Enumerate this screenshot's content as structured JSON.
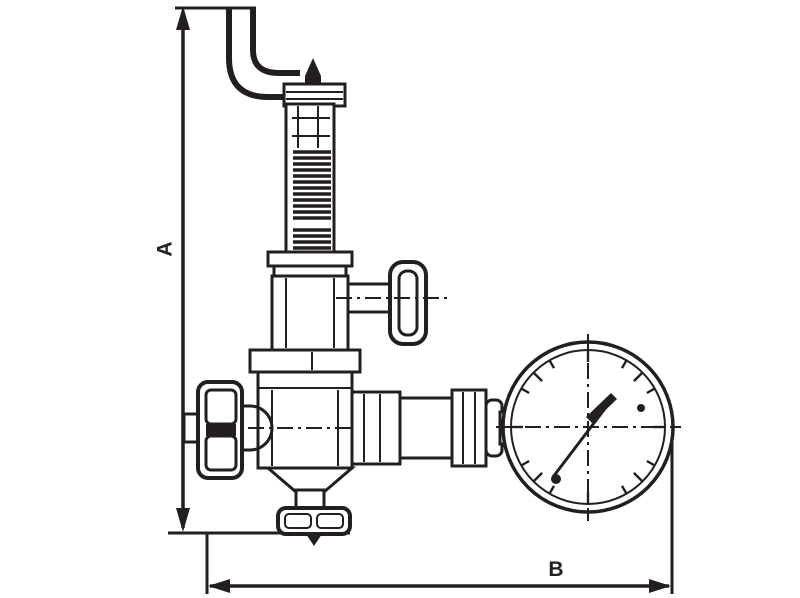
{
  "diagram": {
    "kind": "technical-line-drawing",
    "subject": "safety relief valve with side handle and pressure gauge, with overall dimensions",
    "labels": {
      "dimension_vertical": "A",
      "dimension_horizontal": "B"
    },
    "colors": {
      "line": "#231f20",
      "background": "#ffffff"
    },
    "components": [
      "exhaust-pipe-elbow",
      "stem-tip",
      "spring-housing",
      "housing-flange",
      "bonnet",
      "adjustment-t-handle",
      "body-flange",
      "valve-body",
      "inlet-union-nut",
      "inlet-stub",
      "outlet-neck",
      "outlet-cylinder",
      "outlet-hex-nut",
      "gauge-adapter",
      "pressure-gauge",
      "gauge-needle",
      "drain-cap"
    ]
  }
}
